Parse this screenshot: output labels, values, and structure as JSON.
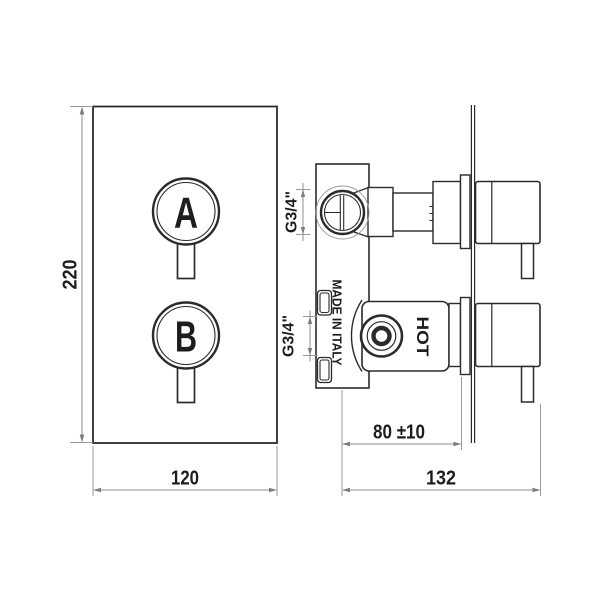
{
  "front_view": {
    "knob_a_label": "A",
    "knob_b_label": "B",
    "height_dim": "220",
    "width_dim": "120"
  },
  "side_view": {
    "hot_label": "HOT",
    "origin_label": "MADE IN ITALY",
    "top_port_label": "G3/4\"",
    "bottom_port_label": "G3/4\"",
    "depth_to_wall_dim": "80 ±10",
    "overall_depth_dim": "132"
  },
  "colors": {
    "background": "#ffffff",
    "line": "#2b2b2b",
    "dimension_line": "#8f8f8f",
    "text": "#1d1d1d"
  }
}
